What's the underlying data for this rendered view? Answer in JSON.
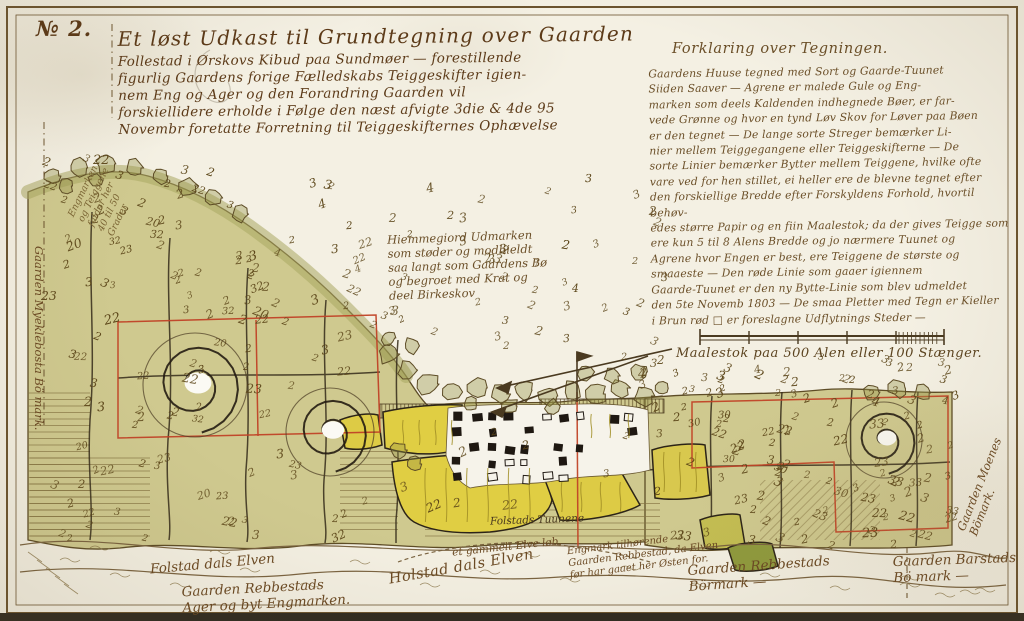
{
  "frame": {
    "number_label": "№ 2."
  },
  "title": {
    "lines": [
      "Et løst Udkast til Grundtegning over Gaarden",
      "Follestad i Ørskovs Kibud paa Sundmøer — forestillende",
      "figurlig Gaardens forige Fælledskabs Teiggeskifter igien-",
      "nem Eng og Ager og den Forandring Gaarden vil",
      "forskiellidere erholde i Følge den næst afvigte 3die & 4de 95",
      "Novembr foretatte Forretning til Teiggeskifternes Ophævelse"
    ]
  },
  "legend": {
    "heading": "Forklaring over Tegningen.",
    "lines": [
      "Gaardens Huuse tegned med Sort og Gaarde-Tuunet",
      "Siiden Saaver — Agrene er malede Gule og Eng-",
      "marken som deels Kaldenden indhegnede Bøer, er far-",
      "vede Grønne og hvor en tynd Løv Skov for Løver paa Bøen",
      "er den tegnet — De lange sorte Streger bemærker Li-",
      "nier mellem Teiggegangene eller Teiggeskifterne — De",
      "sorte Linier bemærker Bytter mellem Teiggene, hvilke ofte",
      "vare ved for hen stillet, ei heller ere de blevne tegnet efter",
      "den forskiellige Bredde efter Forskyldens Forhold, hvortil behøv-",
      "edes større Papir og en fiin Maalestok; da der gives Teigge som",
      "ere kun 5 til 8 Alens Bredde og jo nærmere Tuunet og",
      "Agrene hvor Engen er best, ere Teiggene de største og",
      "smaaeste — Den røde Linie som gaaer igiennem",
      "Gaarde-Tuunet er den ny Bytte-Linie som blev udmeldet",
      "den 5te Novemb 1803 — De smaa Pletter med Tegn er Kieller",
      "i Brun rød □ er foreslagne Udflytnings Steder —"
    ]
  },
  "scale": {
    "label": "Maalestok paa 500 Alen eller 100 Stænger."
  },
  "center_note": {
    "lines": [
      "Hiemmegiord Udmarken",
      "som støder og modhieldt",
      "saa langt som Gaardens Bø",
      "og begroet med Krat og",
      "deel Birkeskov"
    ]
  },
  "slope_note": {
    "lines": [
      "Engmarken",
      "og Teiggene",
      "falder her",
      "40 til 50",
      "Grader"
    ]
  },
  "labels": {
    "river_left": "Folstad dals Elven",
    "old_course": "et gammelt Elve løb.",
    "river_mid": "Holstad dals Elven",
    "tun": "Folstads Tuunene",
    "rebbestad_ager": [
      "Gaarden Rebbestads",
      "Ager og byt Engmarken."
    ],
    "engmark_note": [
      "Engmark tilhørende",
      "Gaarden Rebbestad, da Elven",
      "før har gaaet her Østen for."
    ],
    "rebbestad_bomark": [
      "Gaarden Rebbestads",
      "Börmark —"
    ],
    "barstad": [
      "Gaarden Barstads",
      "Bö mark —"
    ],
    "moenes": [
      "Gaarden Moenes",
      "Bömark."
    ],
    "myklebostad": "Gaarden Myeklebosta Bö mark."
  },
  "colors": {
    "parchment": "#f4f0e3",
    "field_green": "#cfc98f",
    "hill_wash": "#a9a863",
    "ager_yellow": "#e0ce43",
    "dark_olive": "#8f9a3d",
    "ink_brown": "#6b4a24",
    "strip_line": "#837140",
    "red_line": "#c14327",
    "black_line": "#352b1a",
    "house_black": "#1f1812"
  },
  "scatter": [
    {
      "region": [
        235,
        170,
        665,
        340
      ],
      "count": 62,
      "values": [
        "2",
        "3",
        "3",
        "2",
        "3",
        "2",
        "2",
        "3",
        "4",
        "2",
        "3",
        "2"
      ]
    },
    {
      "region": [
        40,
        212,
        380,
        535
      ],
      "count": 95,
      "values": [
        "2",
        "22",
        "3",
        "2",
        "23",
        "2",
        "32",
        "2",
        "3",
        "2",
        "22",
        "2",
        "3",
        "20",
        "2"
      ]
    },
    {
      "region": [
        648,
        400,
        948,
        540
      ],
      "count": 75,
      "values": [
        "2",
        "22",
        "2",
        "3",
        "23",
        "2",
        "2",
        "33",
        "2",
        "2",
        "3",
        "30",
        "2",
        "22",
        "2"
      ]
    },
    {
      "region": [
        600,
        352,
        955,
        396
      ],
      "count": 42,
      "values": [
        "2",
        "3",
        "2",
        "3",
        "3",
        "2",
        "2",
        "3",
        "2",
        "4"
      ]
    },
    {
      "region": [
        42,
        152,
        230,
        212
      ],
      "count": 16,
      "values": [
        "2",
        "3",
        "22",
        "2",
        "3",
        "2"
      ]
    },
    {
      "region": [
        388,
        420,
        660,
        530
      ],
      "count": 10,
      "values": [
        "2",
        "3",
        "22",
        "2"
      ]
    }
  ]
}
